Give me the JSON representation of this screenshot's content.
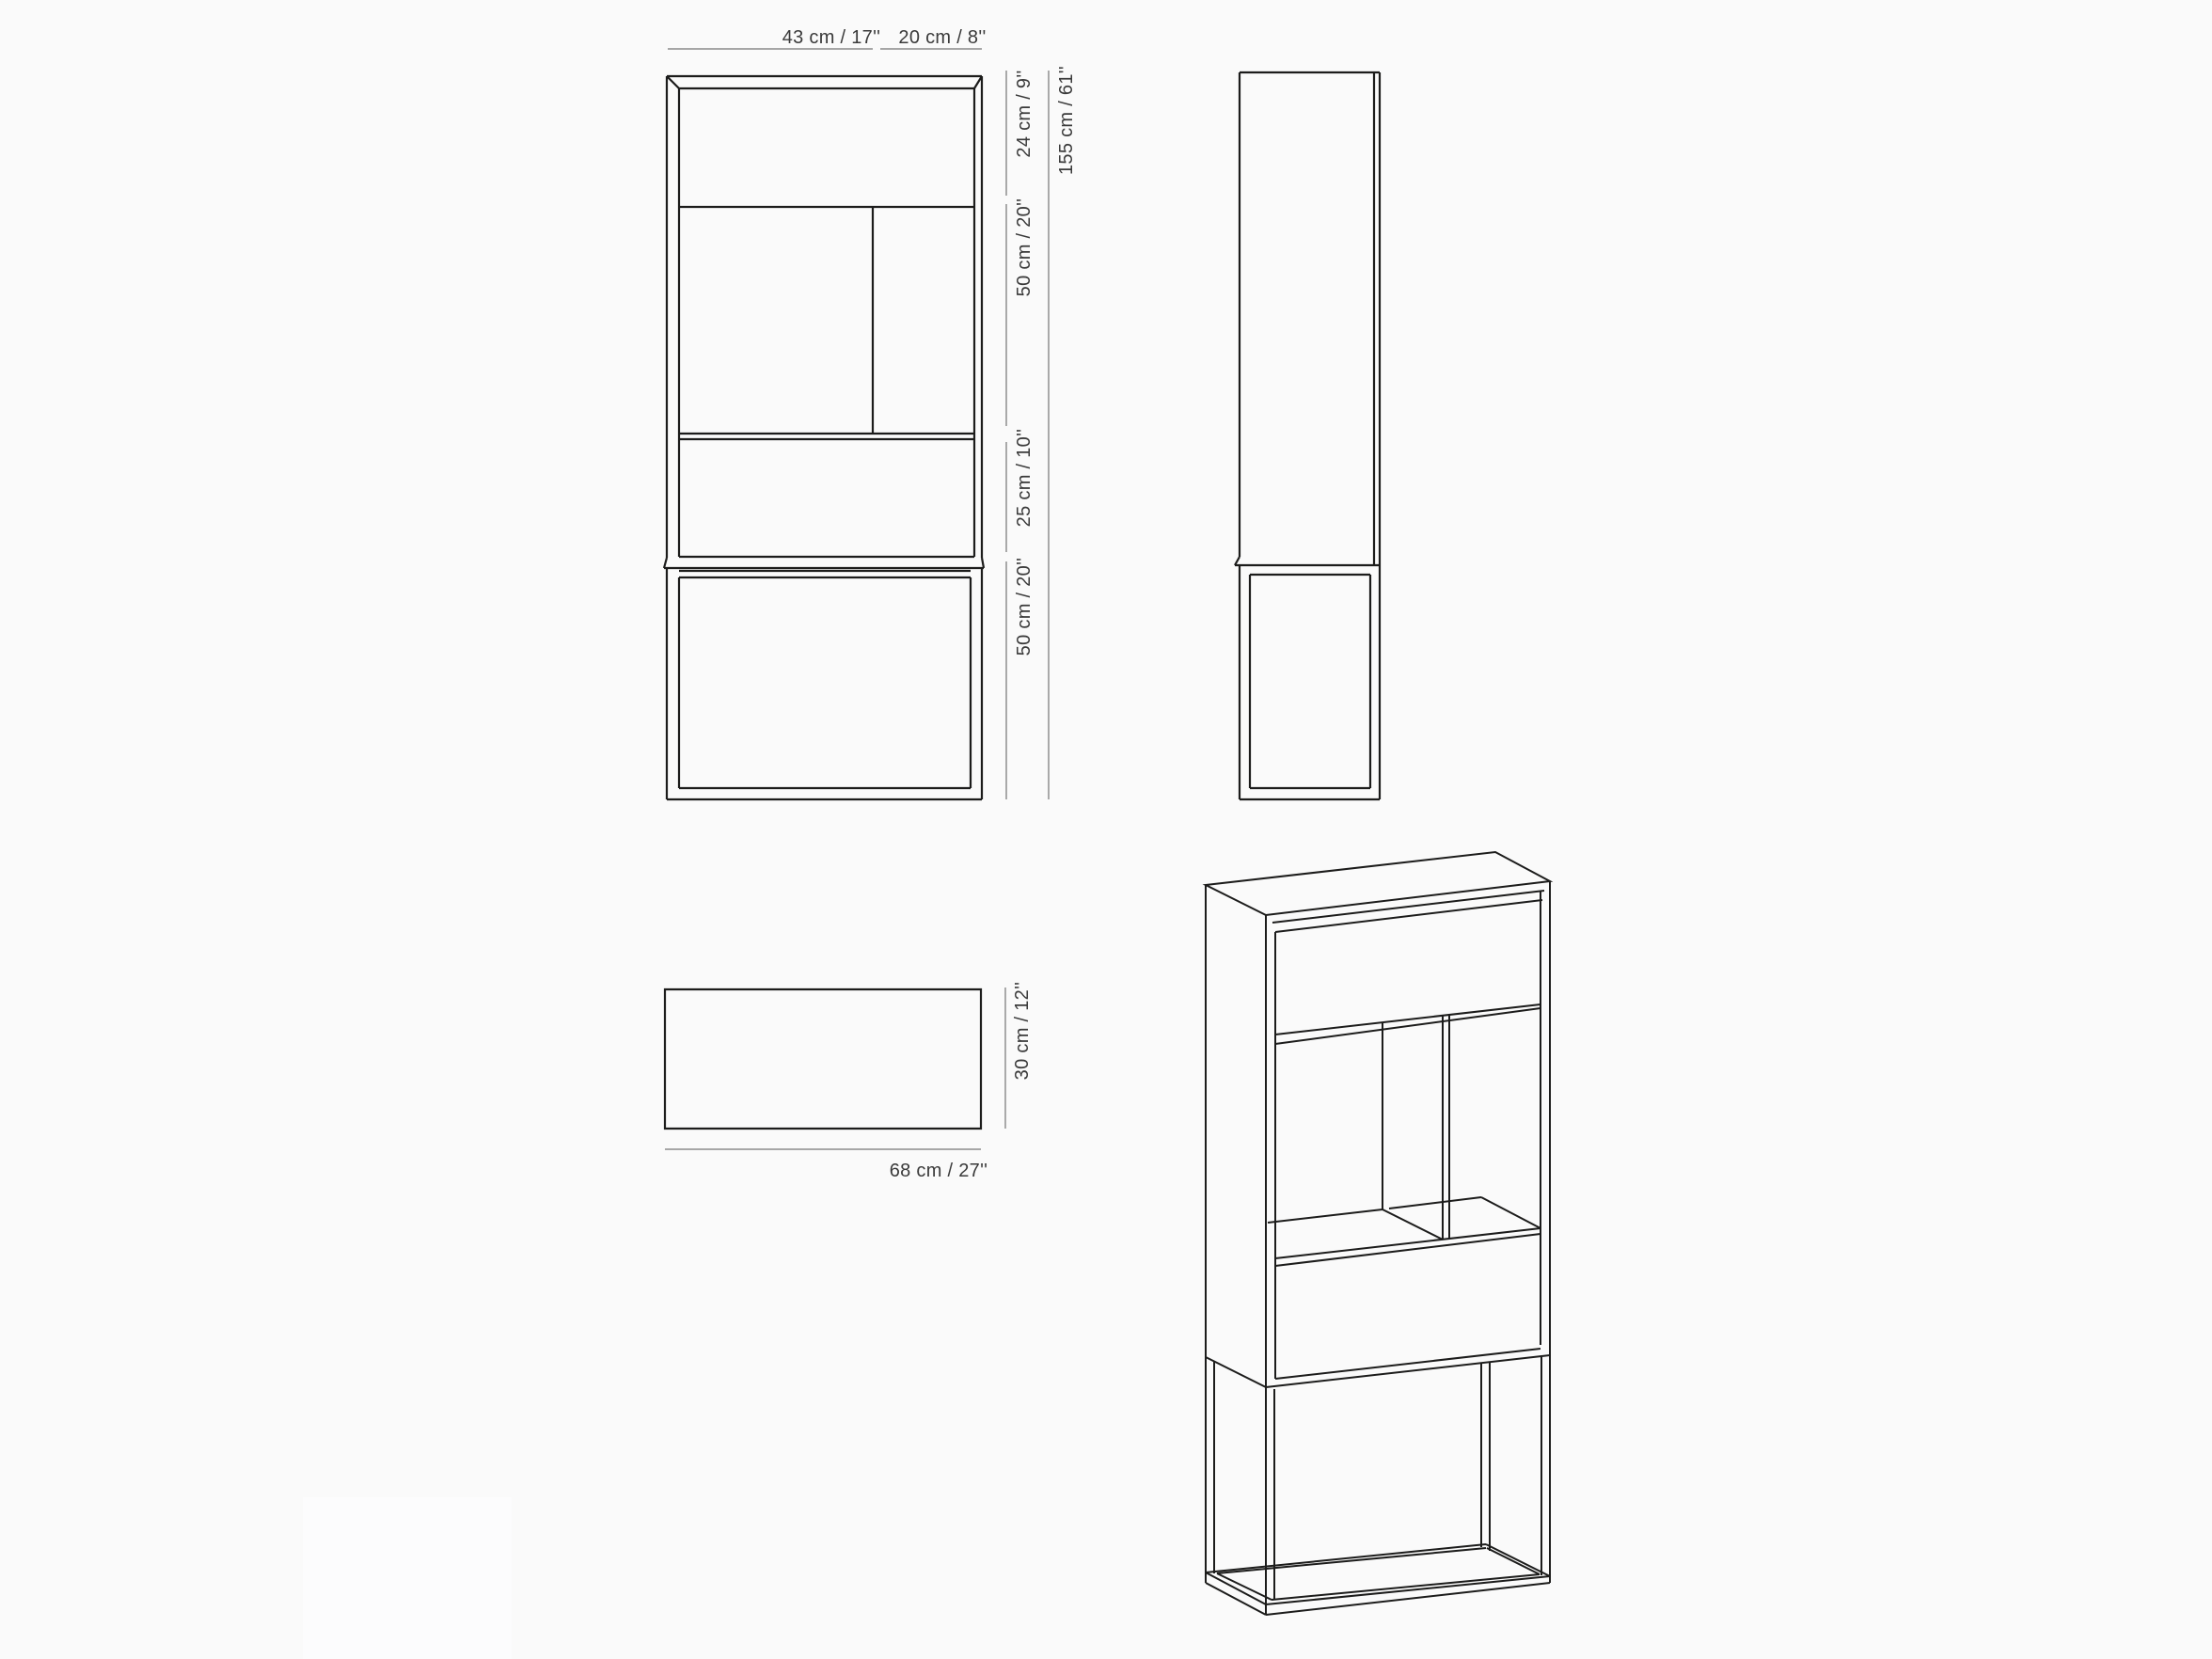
{
  "page": {
    "background_color": "#fafafa"
  },
  "drawing": {
    "subject": "cabinet-technical-drawing",
    "line_color": "#1c1c1b",
    "dimension_line_color": "#9b9b9b",
    "label_color": "#3a3a3a"
  },
  "dimensions": {
    "front_width_left": "43 cm / 17''",
    "front_width_right": "20 cm / 8''",
    "front_height_seg1": "24 cm / 9''",
    "front_height_seg2": "50 cm / 20''",
    "front_height_seg3": "25 cm / 10''",
    "front_height_seg4": "50 cm / 20''",
    "front_total_height": "155 cm / 61''",
    "plan_width": "68 cm / 27''",
    "plan_depth": "30 cm / 12''"
  }
}
